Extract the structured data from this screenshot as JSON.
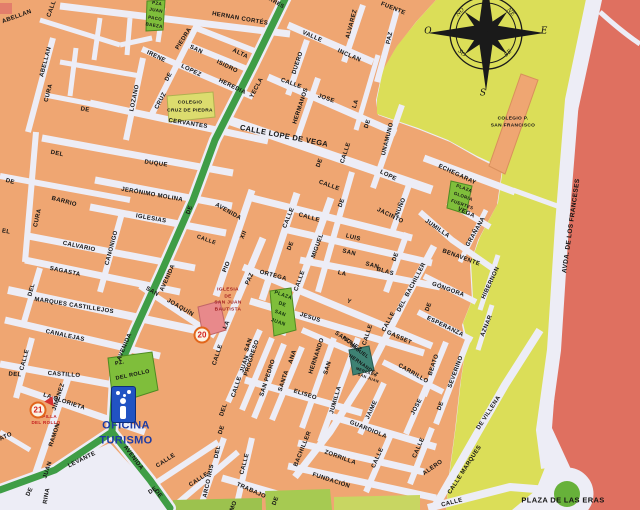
{
  "map": {
    "colors": {
      "block_orange": "#EFA672",
      "street": "#EDEDF6",
      "open_yellow": "#DBDE58",
      "avenue_red": "#DF7060",
      "green_road": "#3F9D46",
      "plaza_green": "#7FBE3B",
      "mercado_teal": "#3E8273",
      "iglesia_pink": "#E8898B",
      "colegio_block": "#DCDC6E",
      "badge_ring": "#E2661B",
      "badge_number": "#D42020",
      "tourism_blue": "#2153C3",
      "tourism_text": "#1D3BA4"
    },
    "street_labels": [
      {
        "t": "ABELLAN",
        "x": 17,
        "y": 17,
        "r": -20
      },
      {
        "t": "CALL",
        "x": 52,
        "y": 9,
        "r": -70
      },
      {
        "t": "ABELLAN",
        "x": 46,
        "y": 62,
        "r": -75
      },
      {
        "t": "CURA",
        "x": 49,
        "y": 93,
        "r": -75
      },
      {
        "t": "CURA",
        "x": 38,
        "y": 218,
        "r": -77
      },
      {
        "t": "DE",
        "x": 10,
        "y": 182,
        "r": 15
      },
      {
        "t": "EL",
        "x": 6,
        "y": 232,
        "r": 10
      },
      {
        "t": "BARRIO",
        "x": 64,
        "y": 202,
        "r": 15
      },
      {
        "t": "LOZANO",
        "x": 135,
        "y": 98,
        "r": -78
      },
      {
        "t": "CRUZ",
        "x": 161,
        "y": 101,
        "r": -62
      },
      {
        "t": "DE",
        "x": 169,
        "y": 77,
        "r": -62
      },
      {
        "t": "PIEDRA",
        "x": 184,
        "y": 39,
        "r": -58
      },
      {
        "t": "SAN",
        "x": 196,
        "y": 50,
        "r": 26
      },
      {
        "t": "ISIDRO",
        "x": 227,
        "y": 67,
        "r": 26
      },
      {
        "t": "IRENE",
        "x": 156,
        "y": 57,
        "r": 26
      },
      {
        "t": "LOPEZ",
        "x": 191,
        "y": 71,
        "r": 26
      },
      {
        "t": "HEREDIA",
        "x": 232,
        "y": 87,
        "r": 26
      },
      {
        "t": "ALTA",
        "x": 240,
        "y": 54,
        "r": 26
      },
      {
        "t": "HERNAN CORTÉS",
        "x": 240,
        "y": 19,
        "r": 10
      },
      {
        "t": "ARES",
        "x": 276,
        "y": 4,
        "r": 30,
        "s": 5.5
      },
      {
        "t": "CERVANTES",
        "x": 188,
        "y": 124,
        "r": 9
      },
      {
        "t": "DE",
        "x": 85,
        "y": 110,
        "r": 10
      },
      {
        "t": "DEL",
        "x": 57,
        "y": 154,
        "r": 12
      },
      {
        "t": "DUQUE",
        "x": 156,
        "y": 164,
        "r": 8
      },
      {
        "t": "JERÓNIMO MOLINA",
        "x": 152,
        "y": 195,
        "r": 10
      },
      {
        "t": "IGLESIAS",
        "x": 151,
        "y": 219,
        "r": 10
      },
      {
        "t": "CALVARIO",
        "x": 79,
        "y": 247,
        "r": 12
      },
      {
        "t": "CANONIGO",
        "x": 112,
        "y": 248,
        "r": -75
      },
      {
        "t": "SAGASTA",
        "x": 65,
        "y": 272,
        "r": 12
      },
      {
        "t": "DEL",
        "x": 32,
        "y": 290,
        "r": -75
      },
      {
        "t": "MARQUES CASTILLEJOS",
        "x": 74,
        "y": 306,
        "r": 9
      },
      {
        "t": "CANALEJAS",
        "x": 65,
        "y": 336,
        "r": 12
      },
      {
        "t": "CALLE",
        "x": 25,
        "y": 360,
        "r": -75
      },
      {
        "t": "DEL",
        "x": 15,
        "y": 375,
        "r": 4
      },
      {
        "t": "CASTILLO",
        "x": 64,
        "y": 375,
        "r": 4
      },
      {
        "t": "LA GLORIETA",
        "x": 64,
        "y": 402,
        "r": 18
      },
      {
        "t": "JIMENEZ",
        "x": 59,
        "y": 397,
        "r": -72
      },
      {
        "t": "RAMON",
        "x": 55,
        "y": 435,
        "r": -72
      },
      {
        "t": "JUAN",
        "x": 48,
        "y": 470,
        "r": -72
      },
      {
        "t": "DE",
        "x": 30,
        "y": 492,
        "r": -65
      },
      {
        "t": "ATO",
        "x": 6,
        "y": 437,
        "r": -25
      },
      {
        "t": "RINA",
        "x": 47,
        "y": 496,
        "r": -80
      },
      {
        "t": "YECLA",
        "x": 257,
        "y": 88,
        "r": -62
      },
      {
        "t": "DE",
        "x": 190,
        "y": 210,
        "r": -70
      },
      {
        "t": "AVENIDA",
        "x": 168,
        "y": 278,
        "r": -66
      },
      {
        "t": "AVENIDA",
        "x": 125,
        "y": 347,
        "r": -67
      },
      {
        "t": "LEVANTE",
        "x": 82,
        "y": 460,
        "r": -26
      },
      {
        "t": "AVENIDA",
        "x": 133,
        "y": 458,
        "r": 53
      },
      {
        "t": "DE",
        "x": 158,
        "y": 494,
        "r": 53
      },
      {
        "t": "SAN",
        "x": 152,
        "y": 292,
        "r": 30
      },
      {
        "t": "JOAQUÍN",
        "x": 180,
        "y": 308,
        "r": 30
      },
      {
        "t": "VALLE",
        "x": 312,
        "y": 37,
        "r": 24
      },
      {
        "t": "INCLAN",
        "x": 349,
        "y": 56,
        "r": 24
      },
      {
        "t": "ALVAREZ",
        "x": 352,
        "y": 24,
        "r": -75
      },
      {
        "t": "FUENTE",
        "x": 393,
        "y": 9,
        "r": 22
      },
      {
        "t": "PAZ",
        "x": 390,
        "y": 38,
        "r": -78
      },
      {
        "t": "DUERO",
        "x": 298,
        "y": 63,
        "r": -72
      },
      {
        "t": "CALLE",
        "x": 291,
        "y": 84,
        "r": 20
      },
      {
        "t": "HERMANOS",
        "x": 301,
        "y": 106,
        "r": -72
      },
      {
        "t": "JOSE",
        "x": 326,
        "y": 99,
        "r": 20
      },
      {
        "t": "LA",
        "x": 356,
        "y": 104,
        "r": -72
      },
      {
        "t": "DE",
        "x": 368,
        "y": 124,
        "r": -72
      },
      {
        "t": "UNAMUNO",
        "x": 388,
        "y": 139,
        "r": -76
      },
      {
        "t": "CALLE LOPE DE VEGA",
        "x": 284,
        "y": 136,
        "r": 11,
        "s": 7.5
      },
      {
        "t": "CALLE",
        "x": 346,
        "y": 153,
        "r": -72
      },
      {
        "t": "DE",
        "x": 320,
        "y": 163,
        "r": -70
      },
      {
        "t": "LOPE",
        "x": 388,
        "y": 176,
        "r": 26
      },
      {
        "t": "CALLE",
        "x": 329,
        "y": 186,
        "r": 20
      },
      {
        "t": "CALLE",
        "x": 206,
        "y": 241,
        "r": 20,
        "s": 5.5
      },
      {
        "t": "AVENIDA",
        "x": 228,
        "y": 212,
        "r": 30
      },
      {
        "t": "XII",
        "x": 244,
        "y": 235,
        "r": -66
      },
      {
        "t": "PIO",
        "x": 227,
        "y": 267,
        "r": -68
      },
      {
        "t": "CALLE",
        "x": 289,
        "y": 218,
        "r": -68
      },
      {
        "t": "DE",
        "x": 291,
        "y": 246,
        "r": -68
      },
      {
        "t": "CALLE",
        "x": 309,
        "y": 218,
        "r": 16
      },
      {
        "t": "JACINTO",
        "x": 390,
        "y": 216,
        "r": 26
      },
      {
        "t": "NUÑO",
        "x": 401,
        "y": 207,
        "r": -68
      },
      {
        "t": "DE",
        "x": 342,
        "y": 203,
        "r": -70
      },
      {
        "t": "CALLE",
        "x": 300,
        "y": 281,
        "r": -70
      },
      {
        "t": "MIGUEL",
        "x": 318,
        "y": 246,
        "r": -70
      },
      {
        "t": "LUIS",
        "x": 353,
        "y": 238,
        "r": 14
      },
      {
        "t": "SAN",
        "x": 349,
        "y": 253,
        "r": 14
      },
      {
        "t": "LA",
        "x": 342,
        "y": 274,
        "r": 14
      },
      {
        "t": "DE",
        "x": 396,
        "y": 257,
        "r": -70
      },
      {
        "t": "SAN",
        "x": 372,
        "y": 266,
        "r": 16
      },
      {
        "t": "BLAS",
        "x": 385,
        "y": 272,
        "r": 16
      },
      {
        "t": "PAZ",
        "x": 250,
        "y": 279,
        "r": -66
      },
      {
        "t": "LA",
        "x": 227,
        "y": 325,
        "r": -66
      },
      {
        "t": "ORTEGA",
        "x": 273,
        "y": 276,
        "r": 15
      },
      {
        "t": "Y",
        "x": 349,
        "y": 302,
        "r": 20
      },
      {
        "t": "GASSET",
        "x": 399,
        "y": 338,
        "r": 24
      },
      {
        "t": "CALLE",
        "x": 368,
        "y": 335,
        "r": -72
      },
      {
        "t": "JESUS",
        "x": 310,
        "y": 318,
        "r": 18
      },
      {
        "t": "SANCHEZ",
        "x": 348,
        "y": 342,
        "r": 35
      },
      {
        "t": "JUMILLA",
        "x": 437,
        "y": 229,
        "r": 35
      },
      {
        "t": "BENAVENTE",
        "x": 461,
        "y": 258,
        "r": 20
      },
      {
        "t": "GÓNGORA",
        "x": 448,
        "y": 290,
        "r": 20
      },
      {
        "t": "HIBERNON",
        "x": 491,
        "y": 283,
        "r": -65
      },
      {
        "t": "GRAÑANA",
        "x": 476,
        "y": 232,
        "r": -60
      },
      {
        "t": "DE",
        "x": 429,
        "y": 307,
        "r": -70
      },
      {
        "t": "ESPERANZA",
        "x": 445,
        "y": 327,
        "r": 26
      },
      {
        "t": "AZNAR",
        "x": 487,
        "y": 326,
        "r": -68
      },
      {
        "t": "ECHEGARAY",
        "x": 457,
        "y": 175,
        "r": 25
      },
      {
        "t": "VEGA",
        "x": 466,
        "y": 213,
        "r": 25
      },
      {
        "t": "BACHILLER",
        "x": 416,
        "y": 280,
        "r": -62
      },
      {
        "t": "DEL",
        "x": 402,
        "y": 306,
        "r": -62
      },
      {
        "t": "CALLE",
        "x": 389,
        "y": 322,
        "r": -62
      },
      {
        "t": "CALLE",
        "x": 218,
        "y": 355,
        "r": -72
      },
      {
        "t": "DEL",
        "x": 224,
        "y": 410,
        "r": -72
      },
      {
        "t": "DE",
        "x": 222,
        "y": 430,
        "r": -72
      },
      {
        "t": "SAN",
        "x": 249,
        "y": 345,
        "r": -72
      },
      {
        "t": "JUAN",
        "x": 245,
        "y": 364,
        "r": -72
      },
      {
        "t": "CALLE",
        "x": 237,
        "y": 387,
        "r": -72
      },
      {
        "t": "PROGRESO",
        "x": 252,
        "y": 358,
        "r": -72
      },
      {
        "t": "SAN PEDRO",
        "x": 268,
        "y": 378,
        "r": -72
      },
      {
        "t": "ANA",
        "x": 293,
        "y": 357,
        "r": -72
      },
      {
        "t": "SANTA",
        "x": 284,
        "y": 381,
        "r": -72
      },
      {
        "t": "HERNANDO",
        "x": 317,
        "y": 356,
        "r": -72
      },
      {
        "t": "SAN",
        "x": 328,
        "y": 368,
        "r": -72
      },
      {
        "t": "ELISEO",
        "x": 305,
        "y": 395,
        "r": 18
      },
      {
        "t": "JUMILLA",
        "x": 336,
        "y": 400,
        "r": -74
      },
      {
        "t": "GUARDIOLA",
        "x": 368,
        "y": 430,
        "r": 22
      },
      {
        "t": "JAIME",
        "x": 372,
        "y": 410,
        "r": -65
      },
      {
        "t": "JOSE",
        "x": 417,
        "y": 407,
        "r": -62
      },
      {
        "t": "CARRILLO",
        "x": 413,
        "y": 374,
        "r": 30
      },
      {
        "t": "BEATO",
        "x": 434,
        "y": 365,
        "r": -72
      },
      {
        "t": "SEVERINO",
        "x": 456,
        "y": 372,
        "r": -70
      },
      {
        "t": "DE",
        "x": 441,
        "y": 406,
        "r": -70
      },
      {
        "t": "ZORRILLA",
        "x": 340,
        "y": 458,
        "r": 20
      },
      {
        "t": "BACHILLER",
        "x": 303,
        "y": 449,
        "r": -68
      },
      {
        "t": "FUNDACIÓN",
        "x": 331,
        "y": 481,
        "r": 18
      },
      {
        "t": "TRABAJO",
        "x": 251,
        "y": 491,
        "r": 24
      },
      {
        "t": "CALLE",
        "x": 245,
        "y": 464,
        "r": -75
      },
      {
        "t": "CALLE",
        "x": 166,
        "y": 461,
        "r": -33
      },
      {
        "t": "CALLE",
        "x": 199,
        "y": 480,
        "r": -33
      },
      {
        "t": "DE",
        "x": 153,
        "y": 491,
        "r": -33
      },
      {
        "t": "MO",
        "x": 234,
        "y": 506,
        "r": -70
      },
      {
        "t": "DE",
        "x": 276,
        "y": 501,
        "r": -70
      },
      {
        "t": "DEL",
        "x": 218,
        "y": 452,
        "r": -78
      },
      {
        "t": "ARCO IRIS",
        "x": 209,
        "y": 481,
        "r": -78
      },
      {
        "t": "CALLE",
        "x": 378,
        "y": 458,
        "r": -66
      },
      {
        "t": "CALLE",
        "x": 419,
        "y": 448,
        "r": -66
      },
      {
        "t": "DE VILLENA",
        "x": 489,
        "y": 413,
        "r": -57
      },
      {
        "t": "CALLE MARQUES",
        "x": 465,
        "y": 470,
        "r": -57
      },
      {
        "t": "ALERO",
        "x": 433,
        "y": 468,
        "r": -35
      },
      {
        "t": "CALLE",
        "x": 452,
        "y": 503,
        "r": -14
      },
      {
        "t": "AVDA. DE LOS FRANCESES",
        "x": 572,
        "y": 226,
        "r": -82,
        "s": 6.5
      }
    ],
    "place_labels": [
      {
        "t": "PLAZA DE LAS ERAS",
        "x": 563,
        "y": 500,
        "r": 0,
        "s": 7.5,
        "n": "plaza-de-las-eras-label"
      },
      {
        "t": "PZ.",
        "x": 120,
        "y": 364,
        "r": -12,
        "s": 5.5,
        "n": "pz-del-rollo-label"
      },
      {
        "t": "DEL ROLLO",
        "x": 133,
        "y": 376,
        "r": -12,
        "s": 5.5,
        "n": "pz-del-rollo-label"
      },
      {
        "t": "OFICINA",
        "x": 126,
        "y": 426,
        "r": 0,
        "s": 11,
        "c": "#1D3BA4",
        "n": "tourist-office-label"
      },
      {
        "t": "TURISMO",
        "x": 126,
        "y": 441,
        "r": 0,
        "s": 11,
        "c": "#1D3BA4",
        "n": "tourist-office-label"
      },
      {
        "t": "CAPILLA",
        "x": 46,
        "y": 417,
        "r": 0,
        "s": 4.5,
        "c": "#C41D1D",
        "n": "capilla-del-rollo-label"
      },
      {
        "t": "DEL ROLLO",
        "x": 46,
        "y": 423,
        "r": 0,
        "s": 4.5,
        "c": "#C41D1D",
        "n": "capilla-del-rollo-label"
      },
      {
        "t": "IGLESIA",
        "x": 228,
        "y": 291,
        "r": 0,
        "s": 4.8,
        "c": "#9E1B1B",
        "n": "iglesia-san-juan-label"
      },
      {
        "t": "DE",
        "x": 228,
        "y": 297.5,
        "r": 0,
        "s": 4.8,
        "c": "#9E1B1B",
        "n": "iglesia-san-juan-label"
      },
      {
        "t": "SAN JUAN",
        "x": 228,
        "y": 304,
        "r": 0,
        "s": 4.8,
        "c": "#9E1B1B",
        "n": "iglesia-san-juan-label"
      },
      {
        "t": "BAUTISTA",
        "x": 228,
        "y": 310.5,
        "r": 0,
        "s": 4.8,
        "c": "#9E1B1B",
        "n": "iglesia-san-juan-label"
      },
      {
        "t": "PLAZA",
        "x": 283,
        "y": 296,
        "r": 20,
        "s": 5,
        "c": "#0E2E0E",
        "n": "plaza-san-juan-label"
      },
      {
        "t": "DE",
        "x": 282,
        "y": 305,
        "r": 20,
        "s": 5,
        "c": "#0E2E0E",
        "n": "plaza-san-juan-label"
      },
      {
        "t": "SAN",
        "x": 280,
        "y": 314,
        "r": 20,
        "s": 5,
        "c": "#0E2E0E",
        "n": "plaza-san-juan-label"
      },
      {
        "t": "JUAN",
        "x": 278,
        "y": 323,
        "r": 20,
        "s": 5,
        "c": "#0E2E0E",
        "n": "plaza-san-juan-label"
      },
      {
        "t": "PZA",
        "x": 347,
        "y": 341,
        "r": 35,
        "s": 5,
        "n": "pza-miguel-hernandez-label"
      },
      {
        "t": "MIGUEL",
        "x": 359,
        "y": 352,
        "r": 35,
        "s": 5,
        "n": "pza-miguel-hernandez-label"
      },
      {
        "t": "HERNANDEZ",
        "x": 363,
        "y": 366,
        "r": 35,
        "s": 5,
        "n": "pza-miguel-hernandez-label"
      },
      {
        "t": "MERCADO",
        "x": 366,
        "y": 373,
        "r": 20,
        "s": 3.8,
        "n": "mercado-san-juan-label"
      },
      {
        "t": "SAN JUAN",
        "x": 368,
        "y": 379,
        "r": 20,
        "s": 3.8,
        "n": "mercado-san-juan-label"
      },
      {
        "t": "PZA",
        "x": 157,
        "y": 4,
        "r": 10,
        "s": 4.5,
        "n": "pza-juan-paco-baeza-label"
      },
      {
        "t": "JUAN",
        "x": 156,
        "y": 11,
        "r": 10,
        "s": 4.5,
        "n": "pza-juan-paco-baeza-label"
      },
      {
        "t": "PACO",
        "x": 155,
        "y": 18.5,
        "r": 10,
        "s": 4.5,
        "n": "pza-juan-paco-baeza-label"
      },
      {
        "t": "BAEZA",
        "x": 154,
        "y": 26,
        "r": 10,
        "s": 4.5,
        "n": "pza-juan-paco-baeza-label"
      },
      {
        "t": "PLAZA",
        "x": 464,
        "y": 189,
        "r": 20,
        "s": 4.5,
        "n": "plaza-gloria-fuertes-label"
      },
      {
        "t": "GLORIA",
        "x": 463,
        "y": 197,
        "r": 20,
        "s": 4.5,
        "n": "plaza-gloria-fuertes-label"
      },
      {
        "t": "FUERTES",
        "x": 462,
        "y": 205,
        "r": 20,
        "s": 4.5,
        "n": "plaza-gloria-fuertes-label"
      },
      {
        "t": "COLEGIO",
        "x": 190,
        "y": 104,
        "r": 0,
        "s": 4.8,
        "n": "colegio-cruz-de-piedra-label"
      },
      {
        "t": "CRUZ DE PIEDRA",
        "x": 190,
        "y": 112,
        "r": 0,
        "s": 4.8,
        "n": "colegio-cruz-de-piedra-label"
      },
      {
        "t": "COLEGIO P.",
        "x": 513,
        "y": 120,
        "r": 0,
        "s": 4.8,
        "n": "colegio-san-francisco-label"
      },
      {
        "t": "SAN FRANCISCO",
        "x": 513,
        "y": 127,
        "r": 0,
        "s": 4.8,
        "n": "colegio-san-francisco-label"
      }
    ],
    "compass_labels": [
      {
        "t": "O",
        "x": 428,
        "y": 32,
        "r": 0,
        "s": 9
      },
      {
        "t": "E",
        "x": 544,
        "y": 32,
        "r": 0,
        "s": 9
      },
      {
        "t": "S",
        "x": 483,
        "y": 94,
        "r": 0,
        "s": 9
      },
      {
        "t": "NO",
        "x": 461,
        "y": 13,
        "r": -45,
        "s": 5.5
      },
      {
        "t": "NE",
        "x": 510,
        "y": 13,
        "r": 45,
        "s": 5.5
      },
      {
        "t": "SO",
        "x": 461,
        "y": 54,
        "r": 45,
        "s": 5.5
      },
      {
        "t": "SE",
        "x": 509,
        "y": 54,
        "r": -45,
        "s": 5.5
      }
    ],
    "badges": [
      {
        "num": "20",
        "x": 202,
        "y": 335
      },
      {
        "num": "21",
        "x": 38,
        "y": 410
      }
    ]
  }
}
